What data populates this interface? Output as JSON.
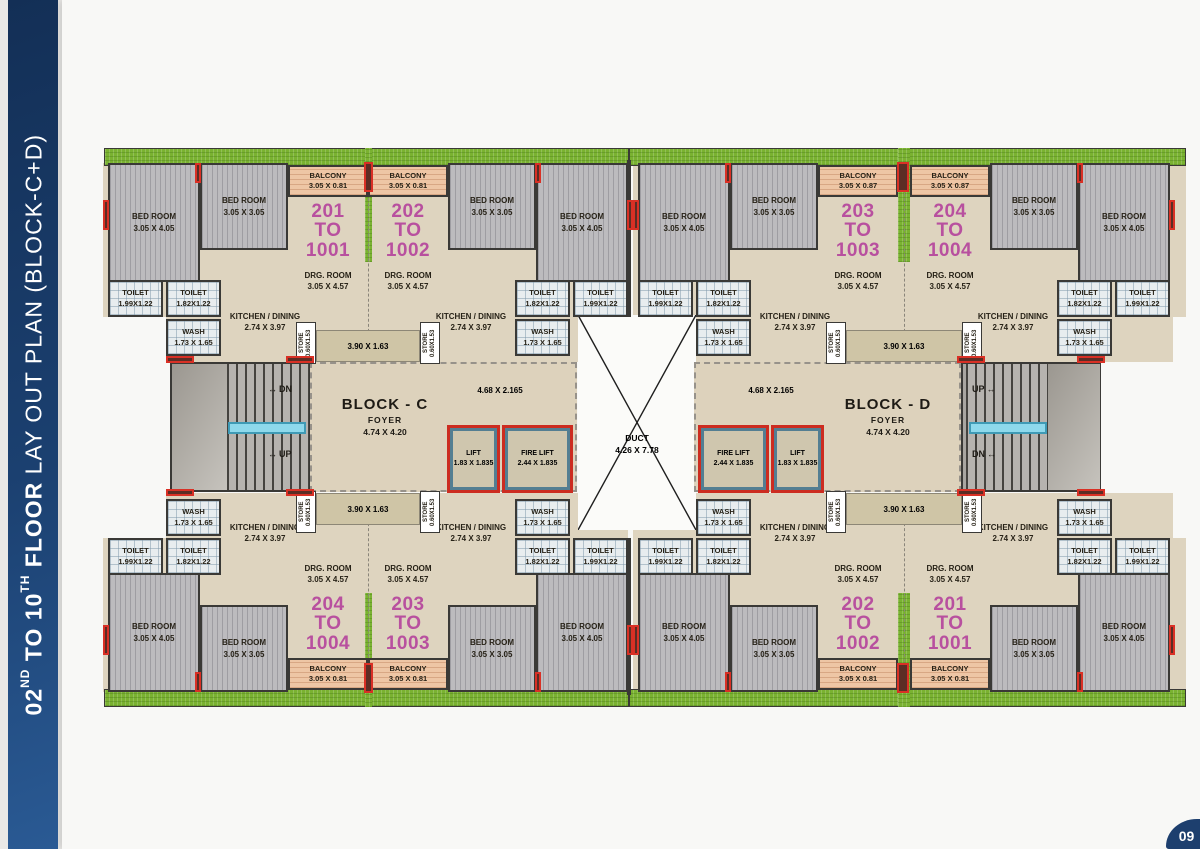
{
  "sidebar": {
    "title_num1": "02",
    "title_sup1": "ND",
    "title_mid": " TO ",
    "title_num2": "10",
    "title_sup2": "TH",
    "title_word": " FLOOR",
    "title_rest": " LAY OUT PLAN (BLOCK-C+D)"
  },
  "page_badge": "09",
  "labels": {
    "bed_l": [
      "BED ROOM",
      "3.05 X 4.05"
    ],
    "bed_s": [
      "BED ROOM",
      "3.05 X 3.05"
    ],
    "balcony_81": [
      "BALCONY",
      "3.05 X 0.81"
    ],
    "balcony_87": [
      "BALCONY",
      "3.05 X 0.87"
    ],
    "drg": [
      "DRG. ROOM",
      "3.05 X 4.57"
    ],
    "kitchen": [
      "KITCHEN / DINING",
      "2.74 X 3.97"
    ],
    "toilet_199": [
      "TOILET",
      "1.99X1.22"
    ],
    "toilet_182": [
      "TOILET",
      "1.82X1.22"
    ],
    "wash": [
      "WASH",
      "1.73 X 1.65"
    ],
    "store": [
      "STORE",
      "0.60X1.53"
    ],
    "passage": "3.90 X 1.63",
    "lift_lobby": "4.68 X 2.165",
    "lift": [
      "LIFT",
      "1.83 X 1.835"
    ],
    "fire_lift": [
      "FIRE LIFT",
      "2.44 X 1.835"
    ],
    "up": "UP",
    "dn": "DN"
  },
  "blocks": [
    {
      "name": "BLOCK - C",
      "foyer_label": "FOYER",
      "foyer_dim": "4.74 X 4.20"
    },
    {
      "name": "BLOCK - D",
      "foyer_label": "FOYER",
      "foyer_dim": "4.74 X 4.20"
    }
  ],
  "duct": [
    "DUCT",
    "4.26 X 7.78"
  ],
  "units": [
    {
      "q": "c-top-left",
      "lines": [
        "201",
        "TO",
        "1001"
      ],
      "balcony": "balcony_81"
    },
    {
      "q": "c-top-right",
      "lines": [
        "202",
        "TO",
        "1002"
      ],
      "balcony": "balcony_81"
    },
    {
      "q": "d-top-left",
      "lines": [
        "203",
        "TO",
        "1003"
      ],
      "balcony": "balcony_87"
    },
    {
      "q": "d-top-right",
      "lines": [
        "204",
        "TO",
        "1004"
      ],
      "balcony": "balcony_87"
    },
    {
      "q": "c-bottom-left",
      "lines": [
        "204",
        "TO",
        "1004"
      ],
      "balcony": "balcony_81"
    },
    {
      "q": "c-bottom-right",
      "lines": [
        "203",
        "TO",
        "1003"
      ],
      "balcony": "balcony_81"
    },
    {
      "q": "d-bottom-left",
      "lines": [
        "202",
        "TO",
        "1002"
      ],
      "balcony": "balcony_81"
    },
    {
      "q": "d-bottom-right",
      "lines": [
        "201",
        "TO",
        "1001"
      ],
      "balcony": "balcony_81"
    }
  ]
}
